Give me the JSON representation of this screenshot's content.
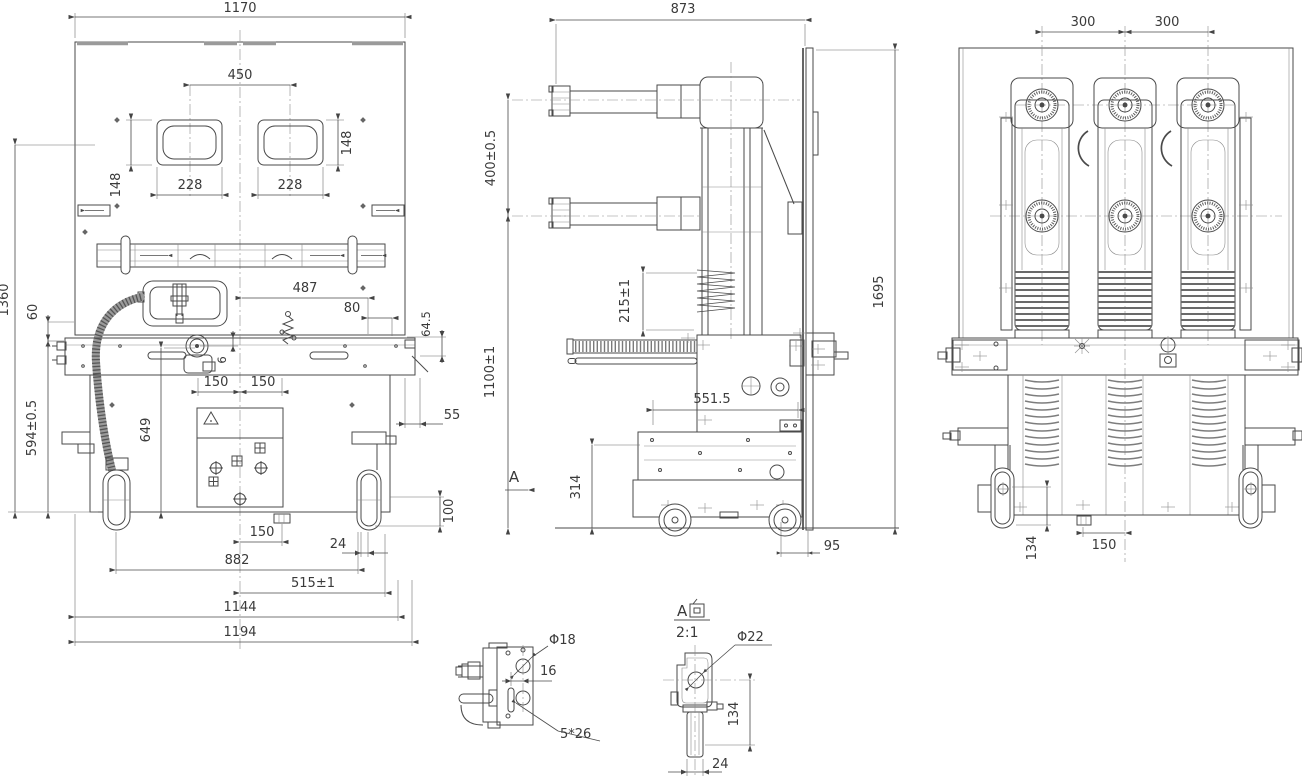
{
  "front": {
    "w1170": "1170",
    "w450": "450",
    "w228a": "228",
    "w228b": "228",
    "h148a": "148",
    "h148b": "148",
    "h1360": "1360",
    "h60": "60",
    "h594": "594±0.5",
    "h649": "649",
    "g6": "6",
    "w487": "487",
    "w80": "80",
    "h64_5": "64.5",
    "w55": "55",
    "h100": "100",
    "w150a": "150",
    "w150b": "150",
    "w150c": "150",
    "w24": "24",
    "w882": "882",
    "w515": "515±1",
    "w1144": "1144",
    "w1194": "1194"
  },
  "side": {
    "w873": "873",
    "h400": "400±0.5",
    "h215": "215±1",
    "h1100": "1100±1",
    "h1695": "1695",
    "w551": "551.5",
    "h314": "314",
    "w95": "95",
    "a": "A"
  },
  "rear": {
    "w300a": "300",
    "w300b": "300",
    "h134": "134",
    "w150": "150"
  },
  "da": {
    "phi18": "Φ18",
    "g16": "16",
    "slot": "5*26"
  },
  "db": {
    "a": "A",
    "full": "A向",
    "scale": "2:1",
    "phi22": "Φ22",
    "h134": "134",
    "w24": "24"
  }
}
